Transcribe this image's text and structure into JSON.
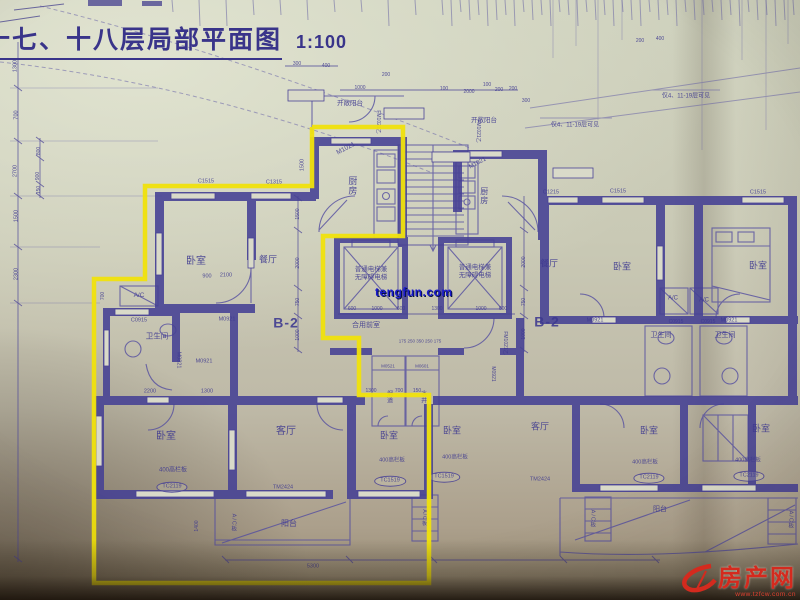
{
  "title": {
    "text": "十七、十八层局部平面图",
    "scale": "1:100"
  },
  "watermark": {
    "text": "tengfun.com",
    "color": "#1a1acc"
  },
  "logo": {
    "site_name": "房产网",
    "url_text": "www.tzfcw.com.cn",
    "color": "#d42a1e"
  },
  "palette": {
    "paper": "#c9c9b5",
    "ink": "#4a4397",
    "wall": "#454094",
    "highlight": "#f0e20c"
  },
  "highlight": {
    "color": "#f0e20c",
    "points": [
      [
        312,
        127
      ],
      [
        403,
        127
      ],
      [
        403,
        236
      ],
      [
        323,
        236
      ],
      [
        323,
        338
      ],
      [
        359,
        338
      ],
      [
        359,
        395
      ],
      [
        429,
        395
      ],
      [
        429,
        583
      ],
      [
        94,
        583
      ],
      [
        94,
        279
      ],
      [
        145,
        279
      ],
      [
        145,
        186
      ],
      [
        312,
        186
      ],
      [
        312,
        127
      ]
    ]
  },
  "annotations": [
    {
      "n": "room-kitchen-left",
      "t": "厨房",
      "x": 352,
      "y": 186,
      "s": 9,
      "v": true
    },
    {
      "n": "door-label-m1021-left",
      "t": "M1021",
      "x": 346,
      "y": 149,
      "s": 6.5,
      "r": -28
    },
    {
      "n": "room-bedroom-1",
      "t": "卧室",
      "x": 196,
      "y": 262,
      "s": 10
    },
    {
      "n": "dim-900",
      "t": "900",
      "x": 207,
      "y": 277,
      "s": 5.5
    },
    {
      "n": "dim-2100",
      "t": "2100",
      "x": 226,
      "y": 276,
      "s": 5.5
    },
    {
      "n": "room-dining-left",
      "t": "餐厅",
      "x": 268,
      "y": 260,
      "s": 9
    },
    {
      "n": "unit-label-b2-left",
      "t": "B-2",
      "x": 286,
      "y": 323,
      "s": 14,
      "b": true
    },
    {
      "n": "ac-label-left",
      "t": "A/C",
      "x": 139,
      "y": 296,
      "s": 6.5
    },
    {
      "n": "win-label-c0915-left",
      "t": "C0915",
      "x": 139,
      "y": 321,
      "s": 5.5
    },
    {
      "n": "room-bath-left",
      "t": "卫生间",
      "x": 157,
      "y": 336,
      "s": 7.5
    },
    {
      "n": "door-label-m0821",
      "t": "M0821",
      "x": 178,
      "y": 360,
      "s": 5.5,
      "r": 90
    },
    {
      "n": "door-label-m0921-a",
      "t": "M0921",
      "x": 204,
      "y": 362,
      "s": 5.5
    },
    {
      "n": "door-label-m0921-b",
      "t": "M0921",
      "x": 227,
      "y": 320,
      "s": 5.5
    },
    {
      "n": "win-label-c1515-left",
      "t": "C1515",
      "x": 206,
      "y": 182,
      "s": 5.5
    },
    {
      "n": "win-label-c1315-left",
      "t": "C1315",
      "x": 274,
      "y": 183,
      "s": 5.5
    },
    {
      "n": "dim-1500-top",
      "t": "1500",
      "x": 303,
      "y": 165,
      "s": 5.5,
      "r": -90
    },
    {
      "n": "room-bedroom-2",
      "t": "卧室",
      "x": 166,
      "y": 437,
      "s": 10
    },
    {
      "n": "dim-2200",
      "t": "2200",
      "x": 150,
      "y": 392,
      "s": 5.5
    },
    {
      "n": "dim-1300-a",
      "t": "1300",
      "x": 207,
      "y": 392,
      "s": 5.5
    },
    {
      "n": "parapet-note-1",
      "t": "400高栏板",
      "x": 173,
      "y": 471,
      "s": 6
    },
    {
      "n": "win-label-tc2119-1",
      "t": "TC2119",
      "x": 172,
      "y": 487,
      "s": 5.5,
      "e": true
    },
    {
      "n": "room-living-left",
      "t": "客厅",
      "x": 286,
      "y": 432,
      "s": 10
    },
    {
      "n": "door-label-tm2424-1",
      "t": "TM2424",
      "x": 283,
      "y": 488,
      "s": 5.5
    },
    {
      "n": "room-balcony-left",
      "t": "阳台",
      "x": 289,
      "y": 524,
      "s": 8
    },
    {
      "n": "ac-board-label-1",
      "t": "A/C板",
      "x": 233,
      "y": 523,
      "s": 5.5,
      "v": true
    },
    {
      "n": "dim-5300",
      "t": "5300",
      "x": 313,
      "y": 567,
      "s": 5.5
    },
    {
      "n": "dim-1400",
      "t": "1400",
      "x": 197,
      "y": 526,
      "s": 5,
      "r": -90
    },
    {
      "n": "dim-700-inner",
      "t": "700",
      "x": 103,
      "y": 296,
      "s": 5,
      "r": -90
    },
    {
      "n": "room-bedroom-3",
      "t": "卧室",
      "x": 389,
      "y": 436,
      "s": 9
    },
    {
      "n": "parapet-note-2",
      "t": "400高栏板",
      "x": 392,
      "y": 461,
      "s": 5.5
    },
    {
      "n": "win-label-tc1519-1",
      "t": "TC1519",
      "x": 390,
      "y": 481,
      "s": 5.5,
      "e": true
    },
    {
      "n": "dim-1300-b",
      "t": "1300",
      "x": 371,
      "y": 391,
      "s": 5
    },
    {
      "n": "dim-700-b",
      "t": "700",
      "x": 399,
      "y": 391,
      "s": 5
    },
    {
      "n": "dim-150-b",
      "t": "150",
      "x": 417,
      "y": 391,
      "s": 5
    },
    {
      "n": "elevator-text-left",
      "t": "普通电梯兼\n无障碍电梯",
      "x": 371,
      "y": 274,
      "s": 6.5
    },
    {
      "n": "elevator-text-right",
      "t": "普通电梯兼\n无障碍电梯",
      "x": 475,
      "y": 272,
      "s": 6.5
    },
    {
      "n": "room-lobby",
      "t": "合用前室",
      "x": 366,
      "y": 326,
      "s": 7
    },
    {
      "n": "dim-600-a",
      "t": "600",
      "x": 352,
      "y": 309,
      "s": 5
    },
    {
      "n": "dim-1000-a",
      "t": "1000",
      "x": 377,
      "y": 309,
      "s": 5
    },
    {
      "n": "dim-600-b",
      "t": "600",
      "x": 401,
      "y": 309,
      "s": 5
    },
    {
      "n": "dim-1300-c",
      "t": "1300",
      "x": 437,
      "y": 309,
      "s": 5
    },
    {
      "n": "dim-1000-b",
      "t": "1000",
      "x": 481,
      "y": 309,
      "s": 5
    },
    {
      "n": "dim-600-c",
      "t": "600",
      "x": 503,
      "y": 309,
      "s": 5
    },
    {
      "n": "dim-row-lobby",
      "t": "175 250 350 250 175",
      "x": 420,
      "y": 341,
      "s": 4.5
    },
    {
      "n": "shaft-label-m0521",
      "t": "M0521",
      "x": 388,
      "y": 366,
      "s": 4.5
    },
    {
      "n": "shaft-label-m0601",
      "t": "M0601",
      "x": 422,
      "y": 366,
      "s": 4.5
    },
    {
      "n": "shaft-flue-label",
      "t": "烟道",
      "x": 388,
      "y": 397,
      "s": 6,
      "v": true
    },
    {
      "n": "shaft-water-label",
      "t": "水井",
      "x": 422,
      "y": 397,
      "s": 6,
      "v": true
    },
    {
      "n": "door-label-fm1021-a",
      "t": "FM1021乙",
      "x": 378,
      "y": 122,
      "s": 5,
      "r": 90
    },
    {
      "n": "door-label-fm1021-b",
      "t": "FM1021乙",
      "x": 478,
      "y": 131,
      "s": 5,
      "r": 90
    },
    {
      "n": "door-label-fm1021-c",
      "t": "FM1021乙",
      "x": 505,
      "y": 343,
      "s": 5,
      "r": 90
    },
    {
      "n": "door-label-m0921-core",
      "t": "M0921",
      "x": 493,
      "y": 374,
      "s": 5,
      "r": 90
    },
    {
      "n": "open-balcony-label-1",
      "t": "开敞阳台",
      "x": 350,
      "y": 104,
      "s": 6.5
    },
    {
      "n": "open-balcony-label-2",
      "t": "开敞阳台",
      "x": 484,
      "y": 121,
      "s": 6.5
    },
    {
      "n": "floors-note-1",
      "t": "仅4、11-19层可见",
      "x": 575,
      "y": 126,
      "s": 6
    },
    {
      "n": "floors-note-2",
      "t": "仅4、11-19层可见",
      "x": 686,
      "y": 97,
      "s": 6
    },
    {
      "n": "room-kitchen-right",
      "t": "厨房",
      "x": 484,
      "y": 196,
      "s": 8,
      "v": true
    },
    {
      "n": "door-label-m1021-right",
      "t": "M1021",
      "x": 478,
      "y": 164,
      "s": 6,
      "r": -28
    },
    {
      "n": "win-label-c1215",
      "t": "C1215",
      "x": 551,
      "y": 193,
      "s": 5.5
    },
    {
      "n": "win-label-c1515-r1",
      "t": "C1515",
      "x": 618,
      "y": 192,
      "s": 5.5
    },
    {
      "n": "win-label-c1515-r2",
      "t": "C1515",
      "x": 758,
      "y": 193,
      "s": 5.5
    },
    {
      "n": "room-dining-right",
      "t": "餐厅",
      "x": 549,
      "y": 264,
      "s": 9
    },
    {
      "n": "unit-label-b2-right",
      "t": "B-2",
      "x": 547,
      "y": 322,
      "s": 14,
      "b": true
    },
    {
      "n": "room-bedroom-r1",
      "t": "卧室",
      "x": 622,
      "y": 267,
      "s": 9
    },
    {
      "n": "room-bedroom-r2",
      "t": "卧室",
      "x": 758,
      "y": 266,
      "s": 9
    },
    {
      "n": "ac-label-r1",
      "t": "A/C",
      "x": 673,
      "y": 299,
      "s": 6
    },
    {
      "n": "ac-label-r2",
      "t": "A/C",
      "x": 704,
      "y": 301,
      "s": 6
    },
    {
      "n": "win-label-c0915-r1",
      "t": "C0915",
      "x": 676,
      "y": 322,
      "s": 5
    },
    {
      "n": "win-label-c0915-r2",
      "t": "C0915",
      "x": 708,
      "y": 322,
      "s": 5
    },
    {
      "n": "room-bath-r1",
      "t": "卫生间",
      "x": 661,
      "y": 336,
      "s": 7
    },
    {
      "n": "room-bath-r2",
      "t": "卫生间",
      "x": 725,
      "y": 336,
      "s": 7
    },
    {
      "n": "door-label-m0921-r1",
      "t": "M0921",
      "x": 595,
      "y": 321,
      "s": 5.5
    },
    {
      "n": "door-label-m0921-r2",
      "t": "M0921",
      "x": 729,
      "y": 321,
      "s": 5.5
    },
    {
      "n": "room-bedroom-4",
      "t": "卧室",
      "x": 452,
      "y": 431,
      "s": 9
    },
    {
      "n": "parapet-note-3",
      "t": "400高栏板",
      "x": 455,
      "y": 458,
      "s": 5.5
    },
    {
      "n": "win-label-tc1519-2",
      "t": "TC1519",
      "x": 444,
      "y": 477,
      "s": 5.5,
      "e": true
    },
    {
      "n": "room-living-right",
      "t": "客厅",
      "x": 540,
      "y": 427,
      "s": 9
    },
    {
      "n": "door-label-tm2424-2",
      "t": "TM2424",
      "x": 540,
      "y": 480,
      "s": 5.5
    },
    {
      "n": "room-bedroom-r3",
      "t": "卧室",
      "x": 649,
      "y": 431,
      "s": 9
    },
    {
      "n": "room-bedroom-r4",
      "t": "卧室",
      "x": 761,
      "y": 429,
      "s": 9
    },
    {
      "n": "parapet-note-4",
      "t": "400高栏板",
      "x": 645,
      "y": 463,
      "s": 5.5
    },
    {
      "n": "parapet-note-5",
      "t": "400高栏板",
      "x": 748,
      "y": 461,
      "s": 5.5
    },
    {
      "n": "win-label-tc2119-r1",
      "t": "TC2119",
      "x": 649,
      "y": 478,
      "s": 5.5,
      "e": true
    },
    {
      "n": "win-label-tc2119-r2",
      "t": "TC2119",
      "x": 749,
      "y": 476,
      "s": 5.5,
      "e": true
    },
    {
      "n": "ac-board-label-2",
      "t": "A/C板",
      "x": 592,
      "y": 519,
      "s": 5.5,
      "v": true
    },
    {
      "n": "ac-board-label-3",
      "t": "A/C板",
      "x": 790,
      "y": 520,
      "s": 5.5,
      "v": true
    },
    {
      "n": "ac-board-label-4",
      "t": "A/C板",
      "x": 424,
      "y": 518,
      "s": 5,
      "v": true
    },
    {
      "n": "room-balcony-right",
      "t": "阳台",
      "x": 660,
      "y": 510,
      "s": 7
    },
    {
      "n": "dim-1300-l",
      "t": "1300",
      "x": 16,
      "y": 66,
      "s": 5.5,
      "r": -90
    },
    {
      "n": "dim-700-l",
      "t": "700",
      "x": 17,
      "y": 115,
      "s": 5.5,
      "r": -90
    },
    {
      "n": "dim-2700-l",
      "t": "2700",
      "x": 16,
      "y": 171,
      "s": 5.5,
      "r": -90
    },
    {
      "n": "dim-1500-l",
      "t": "1500",
      "x": 17,
      "y": 216,
      "s": 5.5,
      "r": -90
    },
    {
      "n": "dim-2300-l",
      "t": "2300",
      "x": 17,
      "y": 274,
      "s": 5.5,
      "r": -90
    },
    {
      "n": "dim-800-l",
      "t": "800",
      "x": 39,
      "y": 151,
      "s": 5,
      "r": -90
    },
    {
      "n": "dim-900-l",
      "t": "900",
      "x": 38,
      "y": 176,
      "s": 5,
      "r": -90
    },
    {
      "n": "dim-150-l",
      "t": "150",
      "x": 39,
      "y": 190,
      "s": 5,
      "r": -90
    },
    {
      "n": "dim-1500-m",
      "t": "1500",
      "x": 298,
      "y": 214,
      "s": 5,
      "r": -90
    },
    {
      "n": "dim-2000-m",
      "t": "2000",
      "x": 298,
      "y": 263,
      "s": 5,
      "r": -90
    },
    {
      "n": "dim-750-m",
      "t": "750",
      "x": 298,
      "y": 302,
      "s": 5,
      "r": -90
    },
    {
      "n": "dim-1000-m",
      "t": "1000",
      "x": 298,
      "y": 335,
      "s": 5,
      "r": -90
    },
    {
      "n": "dim-2000-r",
      "t": "2000",
      "x": 524,
      "y": 262,
      "s": 5,
      "r": -90
    },
    {
      "n": "dim-750-r",
      "t": "750",
      "x": 524,
      "y": 302,
      "s": 5,
      "r": -90
    },
    {
      "n": "dim-1000-r",
      "t": "1000",
      "x": 524,
      "y": 334,
      "s": 5,
      "r": -90
    },
    {
      "n": "dim-300-t1",
      "t": "300",
      "x": 297,
      "y": 64,
      "s": 5
    },
    {
      "n": "dim-400-t1",
      "t": "400",
      "x": 326,
      "y": 66,
      "s": 5
    },
    {
      "n": "dim-1000-t",
      "t": "1000",
      "x": 360,
      "y": 88,
      "s": 5
    },
    {
      "n": "dim-200-t1",
      "t": "200",
      "x": 386,
      "y": 75,
      "s": 5
    },
    {
      "n": "dim-100-t1",
      "t": "100",
      "x": 444,
      "y": 89,
      "s": 5
    },
    {
      "n": "dim-2000-t",
      "t": "2000",
      "x": 469,
      "y": 92,
      "s": 5
    },
    {
      "n": "dim-100-t2",
      "t": "100",
      "x": 487,
      "y": 85,
      "s": 5
    },
    {
      "n": "dim-200-t2",
      "t": "200",
      "x": 499,
      "y": 90,
      "s": 5
    },
    {
      "n": "dim-200-t3",
      "t": "200",
      "x": 513,
      "y": 89,
      "s": 5
    },
    {
      "n": "dim-300-t2",
      "t": "300",
      "x": 526,
      "y": 101,
      "s": 5
    },
    {
      "n": "dim-200-t4",
      "t": "200",
      "x": 640,
      "y": 41,
      "s": 5
    },
    {
      "n": "dim-400-t2",
      "t": "400",
      "x": 660,
      "y": 39,
      "s": 5
    }
  ]
}
